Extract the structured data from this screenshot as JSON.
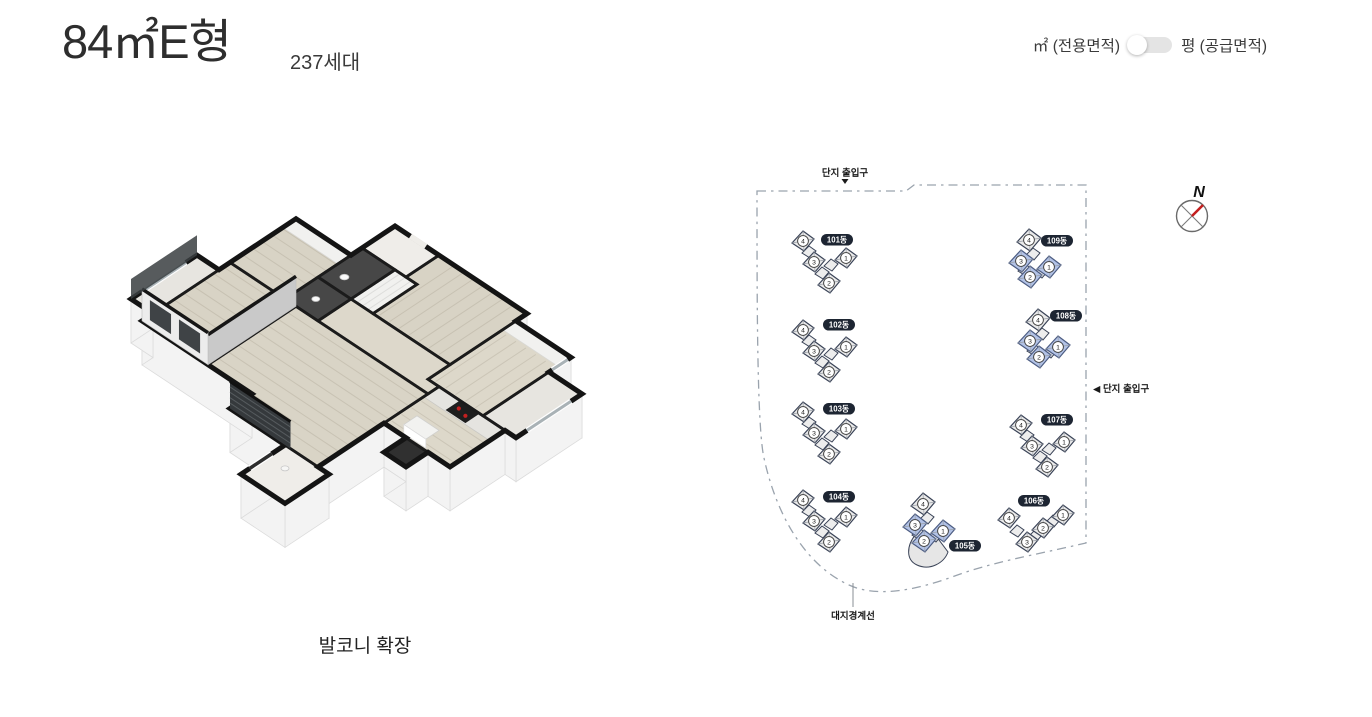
{
  "header": {
    "title": "84㎡E형",
    "household_count": "237세대",
    "area_toggle": {
      "left_label": "㎡ (전용면적)",
      "right_label": "평 (공급면적)",
      "selected": "left"
    }
  },
  "floor_plan": {
    "caption": "발코니 확장"
  },
  "site_map": {
    "top_entrance_label": "단지 출입구",
    "right_entrance_label": "◀ 단지 출입구",
    "boundary_label": "대지경계선",
    "compass_letter": "N",
    "unit_numbers": [
      1,
      2,
      3,
      4
    ],
    "colors": {
      "building_fill": "#e9e9e9",
      "highlight_fill": "#b2c2e6",
      "outline": "#3a4357",
      "label_bg": "#1d2532",
      "boundary": "#9aa3ad",
      "compass_needle": "#c41f1f"
    },
    "buildings": [
      {
        "name": "101동",
        "type": "v",
        "x": 803,
        "y": 241,
        "label_dx": 34,
        "label_dy": -1,
        "highlighted_units": []
      },
      {
        "name": "102동",
        "type": "v",
        "x": 803,
        "y": 330,
        "label_dx": 36,
        "label_dy": -5,
        "highlighted_units": []
      },
      {
        "name": "103동",
        "type": "v",
        "x": 803,
        "y": 412,
        "label_dx": 36,
        "label_dy": -3,
        "highlighted_units": []
      },
      {
        "name": "104동",
        "type": "v",
        "x": 803,
        "y": 500,
        "label_dx": 36,
        "label_dy": -3,
        "highlighted_units": []
      },
      {
        "name": "105동",
        "type": "cluster_podium",
        "x": 923,
        "y": 504,
        "label_dx": 42,
        "label_dy": 42,
        "highlighted_units": [
          1,
          2,
          3
        ]
      },
      {
        "name": "106동",
        "type": "w",
        "x": 1043,
        "y": 528,
        "label_dx": -9,
        "label_dy": -27,
        "highlighted_units": []
      },
      {
        "name": "107동",
        "type": "v",
        "x": 1021,
        "y": 425,
        "label_dx": 36,
        "label_dy": -5,
        "highlighted_units": []
      },
      {
        "name": "108동",
        "type": "cluster",
        "x": 1038,
        "y": 320,
        "label_dx": 28,
        "label_dy": -4,
        "highlighted_units": [
          1,
          2,
          3
        ]
      },
      {
        "name": "109동",
        "type": "cluster",
        "x": 1029,
        "y": 240,
        "label_dx": 28,
        "label_dy": 1,
        "highlighted_units": [
          1,
          2,
          3
        ]
      }
    ]
  }
}
